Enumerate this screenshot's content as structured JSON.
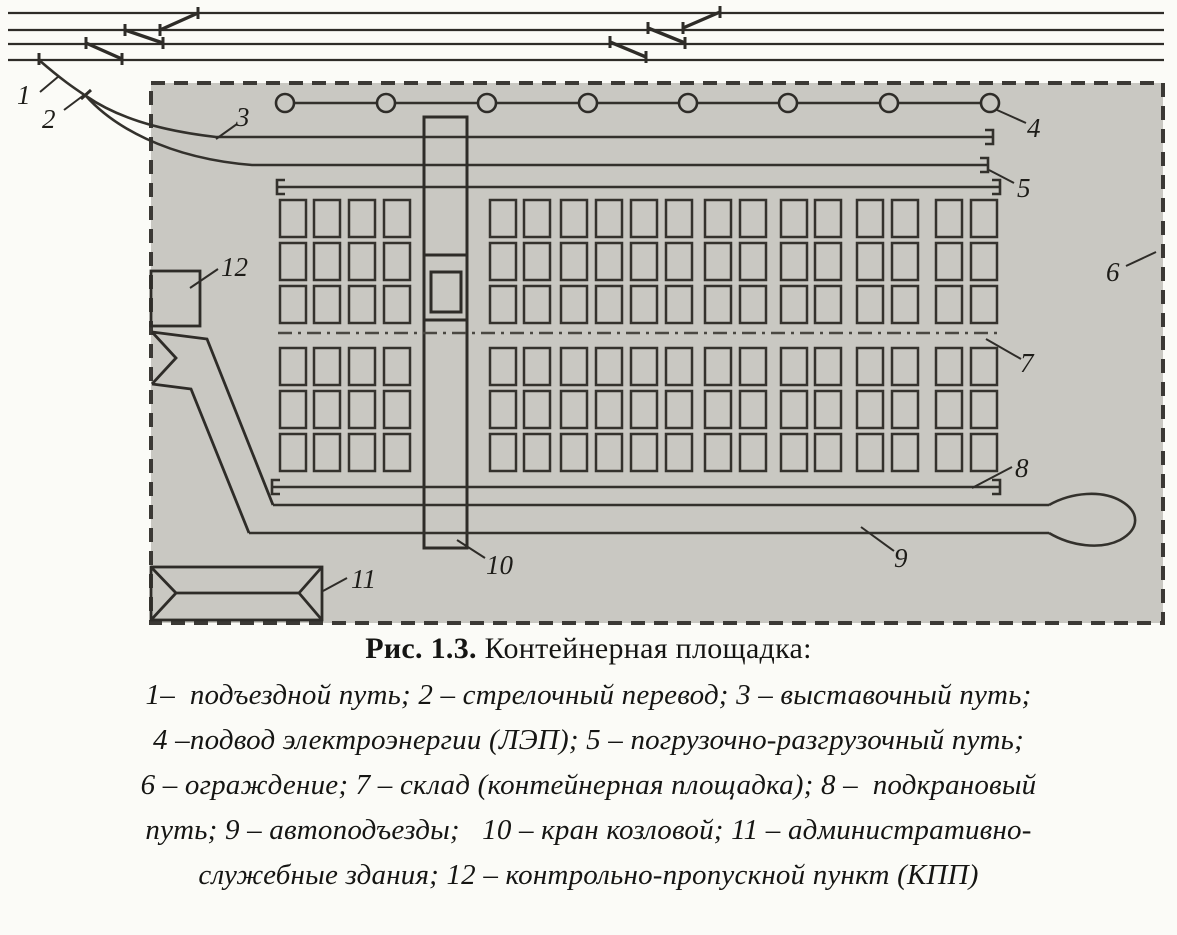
{
  "caption": {
    "title_bold": "Рис. 1.3.",
    "title_rest": " Контейнерная площадка:",
    "legend_lines": [
      "1–  подъездной путь; 2 – стрелочный перевод; 3 – выставочный путь;",
      "4 –подвод электроэнергии (ЛЭП); 5 – погрузочно-разгрузочный путь;",
      "6 – ограждение; 7 – склад (контейнерная площадка); 8 –  подкрановый",
      "путь; 9 – автоподъезды;   10 – кран козловой; 11 – административно-",
      "служебные здания; 12 – контрольно-пропускной пункт (КПП)"
    ]
  },
  "diagram": {
    "labels": {
      "n1": "1",
      "n2": "2",
      "n3": "3",
      "n4": "4",
      "n5": "5",
      "n6": "6",
      "n7": "7",
      "n8": "8",
      "n9": "9",
      "n10": "10",
      "n11": "11",
      "n12": "12"
    },
    "colors": {
      "paper": "#fbfbf7",
      "yard_fill": "#c9c8c2",
      "ink": "#2e2c28"
    },
    "layout": {
      "container_rows_y": [
        200,
        243,
        286,
        348,
        391,
        434
      ],
      "container_cols_x_left": [
        280,
        314,
        349,
        384
      ],
      "container_cols_x_right": [
        490,
        524,
        561,
        596,
        631,
        666,
        705,
        740,
        781,
        815,
        857,
        892,
        936,
        971
      ],
      "container_w": 26,
      "container_h": 37,
      "pole_cx": [
        285,
        386,
        487,
        588,
        688,
        788,
        889,
        990
      ],
      "pole_cy": 103,
      "pole_r": 9
    }
  }
}
